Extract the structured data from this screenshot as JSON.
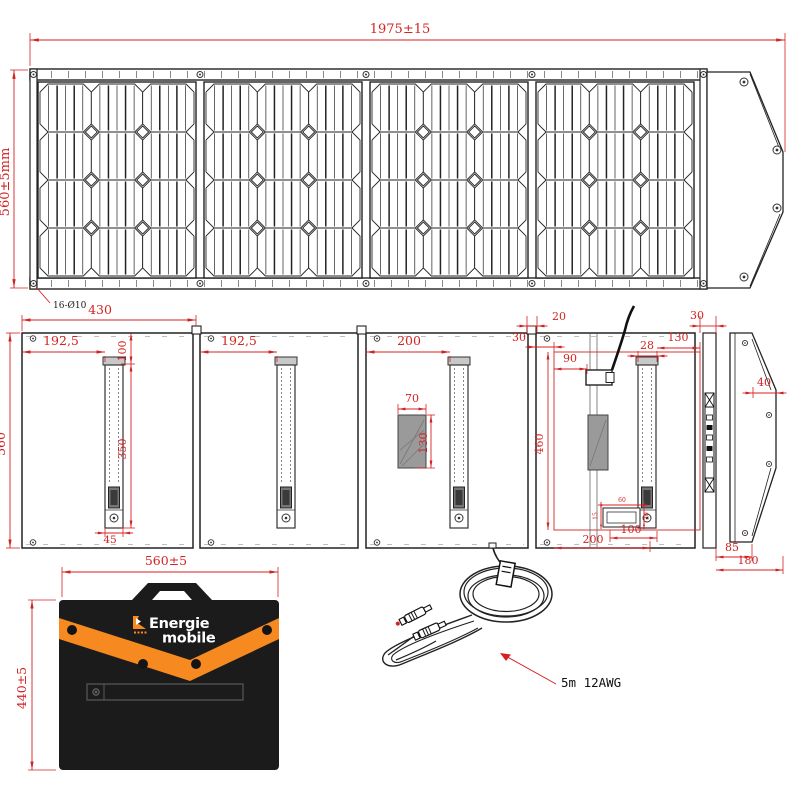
{
  "colors": {
    "dimension_red": "#d42222",
    "line_dark": "#222222",
    "bag_black": "#1b1b1b",
    "accent_orange": "#f6891f"
  },
  "front_view": {
    "width_dim": "1975±15",
    "height_dim": "560±5mm",
    "holes_note": "16-Ø10",
    "panel_count": 4,
    "cell_rows": 4,
    "cell_cols": 3
  },
  "back_view": {
    "height_dim": "560",
    "panel1_width": "430",
    "p1_strap_offset": "192,5",
    "p1_strap_top": "100",
    "p1_strap_length": "350",
    "p1_strap_width": "45",
    "p2_strap_offset": "192,5",
    "p3_strap_offset": "200",
    "p3_box_width": "70",
    "p3_box_height": "130",
    "p4_hinge_gap": "20",
    "p4_edge_inset": "30",
    "p4_gland_offset": "90",
    "p4_inner_height": "460",
    "p4_strap_width": "28",
    "p4_strap_right": "130",
    "p4_pocket_h1": "15",
    "p4_pocket_w": "60",
    "p4_pocket_h2": "20",
    "p4_pocket_offset": "100",
    "p4_bottom_width": "200",
    "spine_width": "30",
    "flap_tip": "40",
    "flap_inner_width": "85",
    "flap_width": "180"
  },
  "bag_view": {
    "width_dim": "560±5",
    "height_dim": "440±5",
    "logo_line1": "Energie",
    "logo_line2": "mobile"
  },
  "cable_view": {
    "label": "5m  12AWG"
  }
}
